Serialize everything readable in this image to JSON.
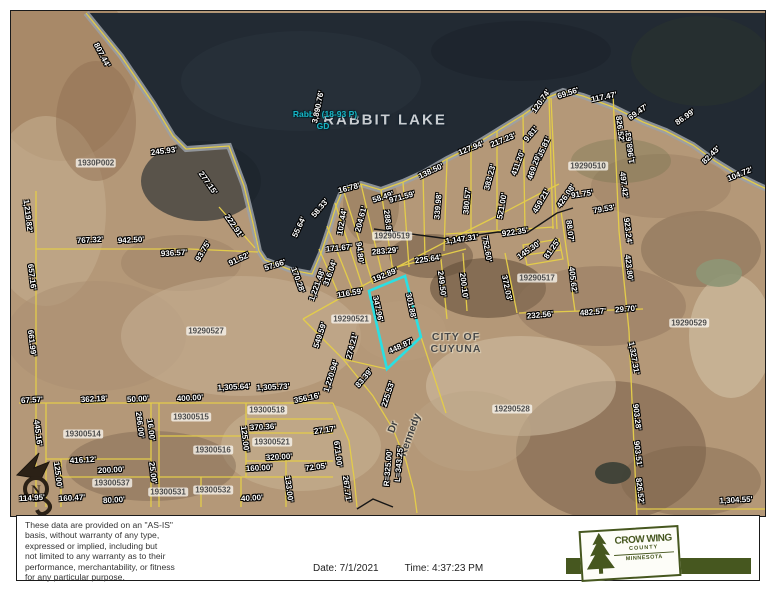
{
  "map": {
    "lake_name": "RABBIT LAKE",
    "lake_id_line1": "Rabbit (18-93 P)",
    "lake_id_line2": "GD",
    "lake_dimension": "3,890.76'",
    "city_line1": "CITY OF",
    "city_line2": "CUYUNA",
    "road_name": "Kennedy",
    "road_suffix": "Dr",
    "north_label": "N",
    "colors": {
      "highlight": "#2bdfe2",
      "parcel_line": "#e3cc4a",
      "water": "#222a33",
      "shore_band": "#9ba1a8",
      "label_text": "#ffffff"
    },
    "measurements": [
      {
        "t": "807.44'",
        "x": 101,
        "y": 54,
        "r": 62
      },
      {
        "t": "245.93'",
        "x": 163,
        "y": 150,
        "r": -7
      },
      {
        "t": "277.15'",
        "x": 207,
        "y": 182,
        "r": 55
      },
      {
        "t": "3,890.76'",
        "x": 317,
        "y": 106,
        "r": -78
      },
      {
        "t": "16.78'",
        "x": 348,
        "y": 187,
        "r": -15
      },
      {
        "t": "58.49'",
        "x": 382,
        "y": 196,
        "r": -18
      },
      {
        "t": "58.33'",
        "x": 319,
        "y": 207,
        "r": -50
      },
      {
        "t": "55.64'",
        "x": 298,
        "y": 226,
        "r": -65
      },
      {
        "t": "102.44'",
        "x": 341,
        "y": 221,
        "r": -80
      },
      {
        "t": "204.61'",
        "x": 360,
        "y": 218,
        "r": -75
      },
      {
        "t": "971.59'",
        "x": 401,
        "y": 196,
        "r": -15
      },
      {
        "t": "138.50'",
        "x": 430,
        "y": 170,
        "r": -25
      },
      {
        "t": "127.94'",
        "x": 470,
        "y": 147,
        "r": -22
      },
      {
        "t": "217.23'",
        "x": 502,
        "y": 139,
        "r": -22
      },
      {
        "t": "9.81'",
        "x": 530,
        "y": 133,
        "r": -50
      },
      {
        "t": "120.74'",
        "x": 540,
        "y": 100,
        "r": -55
      },
      {
        "t": "69.56'",
        "x": 567,
        "y": 92,
        "r": -18
      },
      {
        "t": "117.47'",
        "x": 603,
        "y": 96,
        "r": -12
      },
      {
        "t": "69.47'",
        "x": 637,
        "y": 111,
        "r": -35
      },
      {
        "t": "86.99'",
        "x": 684,
        "y": 116,
        "r": -35
      },
      {
        "t": "82.43'",
        "x": 710,
        "y": 154,
        "r": -45
      },
      {
        "t": "104.72'",
        "x": 739,
        "y": 173,
        "r": -22
      },
      {
        "t": "435.81'",
        "x": 542,
        "y": 148,
        "r": -65
      },
      {
        "t": "469.29'",
        "x": 533,
        "y": 166,
        "r": -70
      },
      {
        "t": "411.20'",
        "x": 517,
        "y": 162,
        "r": -70
      },
      {
        "t": "383.23'",
        "x": 489,
        "y": 176,
        "r": -75
      },
      {
        "t": "521.00'",
        "x": 501,
        "y": 205,
        "r": -80
      },
      {
        "t": "380.57'",
        "x": 466,
        "y": 200,
        "r": -85
      },
      {
        "t": "339.98'",
        "x": 437,
        "y": 205,
        "r": -85
      },
      {
        "t": "426.08'",
        "x": 565,
        "y": 195,
        "r": -55
      },
      {
        "t": "459.21'",
        "x": 540,
        "y": 200,
        "r": -60
      },
      {
        "t": "922.35'",
        "x": 514,
        "y": 231,
        "r": -8
      },
      {
        "t": "91.75'",
        "x": 581,
        "y": 193,
        "r": -8
      },
      {
        "t": "79.53'",
        "x": 603,
        "y": 208,
        "r": -10
      },
      {
        "t": "826.52'",
        "x": 619,
        "y": 128,
        "r": 83
      },
      {
        "t": "1,968.63'",
        "x": 629,
        "y": 146,
        "r": -97
      },
      {
        "t": "497.42'",
        "x": 623,
        "y": 184,
        "r": 83
      },
      {
        "t": "923.24'",
        "x": 627,
        "y": 230,
        "r": 83
      },
      {
        "t": "423.80'",
        "x": 628,
        "y": 267,
        "r": 83
      },
      {
        "t": "88.07'",
        "x": 569,
        "y": 230,
        "r": 83
      },
      {
        "t": "81.25'",
        "x": 551,
        "y": 248,
        "r": -55
      },
      {
        "t": "145.30'",
        "x": 528,
        "y": 249,
        "r": -35
      },
      {
        "t": "752.60'",
        "x": 486,
        "y": 248,
        "r": 80
      },
      {
        "t": "1,147.31'",
        "x": 461,
        "y": 238,
        "r": -8
      },
      {
        "t": "200.10'",
        "x": 463,
        "y": 285,
        "r": 83
      },
      {
        "t": "249.50'",
        "x": 441,
        "y": 283,
        "r": 83
      },
      {
        "t": "225.64'",
        "x": 427,
        "y": 258,
        "r": -8
      },
      {
        "t": "283.29'",
        "x": 384,
        "y": 250,
        "r": -5
      },
      {
        "t": "171.67'",
        "x": 338,
        "y": 247,
        "r": -5
      },
      {
        "t": "94.80'",
        "x": 359,
        "y": 252,
        "r": 83
      },
      {
        "t": "288.87'",
        "x": 387,
        "y": 222,
        "r": 83
      },
      {
        "t": "316.04'",
        "x": 329,
        "y": 272,
        "r": -70
      },
      {
        "t": "1,221.48'",
        "x": 316,
        "y": 284,
        "r": -70
      },
      {
        "t": "170.28'",
        "x": 297,
        "y": 279,
        "r": 70
      },
      {
        "t": "116.59'",
        "x": 349,
        "y": 292,
        "r": -10
      },
      {
        "t": "192.89'",
        "x": 384,
        "y": 274,
        "r": -22
      },
      {
        "t": "347.96'",
        "x": 377,
        "y": 308,
        "r": 78
      },
      {
        "t": "301.88'",
        "x": 410,
        "y": 305,
        "r": 78
      },
      {
        "t": "448.87'",
        "x": 400,
        "y": 345,
        "r": -25
      },
      {
        "t": "549.59'",
        "x": 319,
        "y": 334,
        "r": -72
      },
      {
        "t": "274.21'",
        "x": 351,
        "y": 345,
        "r": -75
      },
      {
        "t": "1,220.94'",
        "x": 330,
        "y": 375,
        "r": -72
      },
      {
        "t": "83.39'",
        "x": 363,
        "y": 377,
        "r": -50
      },
      {
        "t": "225.53'",
        "x": 387,
        "y": 393,
        "r": -72
      },
      {
        "t": "R=325.00'",
        "x": 387,
        "y": 467,
        "r": -85
      },
      {
        "t": "L=343.25'",
        "x": 398,
        "y": 463,
        "r": -85
      },
      {
        "t": "372.03'",
        "x": 506,
        "y": 287,
        "r": 78
      },
      {
        "t": "405.62'",
        "x": 572,
        "y": 279,
        "r": 83
      },
      {
        "t": "232.56'",
        "x": 539,
        "y": 314,
        "r": -5
      },
      {
        "t": "482.57'",
        "x": 592,
        "y": 311,
        "r": -5
      },
      {
        "t": "29.70'",
        "x": 625,
        "y": 308,
        "r": -5
      },
      {
        "t": "1,327.31'",
        "x": 633,
        "y": 357,
        "r": 80
      },
      {
        "t": "903.28'",
        "x": 636,
        "y": 416,
        "r": 83
      },
      {
        "t": "903.51'",
        "x": 637,
        "y": 453,
        "r": 83
      },
      {
        "t": "826.52'",
        "x": 639,
        "y": 490,
        "r": 83
      },
      {
        "t": "1,304.55'",
        "x": 735,
        "y": 499,
        "r": -3
      },
      {
        "t": "767.32'",
        "x": 89,
        "y": 239,
        "r": -3
      },
      {
        "t": "942.50'",
        "x": 130,
        "y": 239,
        "r": -3
      },
      {
        "t": "936.57'",
        "x": 173,
        "y": 252,
        "r": -3
      },
      {
        "t": "93.75'",
        "x": 202,
        "y": 250,
        "r": -60
      },
      {
        "t": "91.52'",
        "x": 238,
        "y": 258,
        "r": -25
      },
      {
        "t": "57.66'",
        "x": 274,
        "y": 264,
        "r": -18
      },
      {
        "t": "222.91'",
        "x": 233,
        "y": 225,
        "r": 55
      },
      {
        "t": "1,219.82'",
        "x": 27,
        "y": 215,
        "r": 83
      },
      {
        "t": "657.16'",
        "x": 31,
        "y": 276,
        "r": 83
      },
      {
        "t": "661.99'",
        "x": 31,
        "y": 342,
        "r": 83
      },
      {
        "t": "67.57'",
        "x": 31,
        "y": 399,
        "r": -3
      },
      {
        "t": "362.18'",
        "x": 93,
        "y": 398,
        "r": -3
      },
      {
        "t": "50.00'",
        "x": 137,
        "y": 398,
        "r": -3
      },
      {
        "t": "400.00'",
        "x": 189,
        "y": 397,
        "r": -3
      },
      {
        "t": "1,305.64'",
        "x": 233,
        "y": 386,
        "r": -3
      },
      {
        "t": "1,305.73'",
        "x": 272,
        "y": 386,
        "r": -3
      },
      {
        "t": "356.16'",
        "x": 306,
        "y": 397,
        "r": -12
      },
      {
        "t": "445.16'",
        "x": 37,
        "y": 432,
        "r": 83
      },
      {
        "t": "416.12'",
        "x": 82,
        "y": 459,
        "r": -3
      },
      {
        "t": "200.00'",
        "x": 110,
        "y": 469,
        "r": -3
      },
      {
        "t": "125.00'",
        "x": 57,
        "y": 474,
        "r": 83
      },
      {
        "t": "266.00'",
        "x": 139,
        "y": 424,
        "r": 83
      },
      {
        "t": "16.00'",
        "x": 150,
        "y": 429,
        "r": 83
      },
      {
        "t": "25.00'",
        "x": 152,
        "y": 472,
        "r": 83
      },
      {
        "t": "125.00'",
        "x": 244,
        "y": 438,
        "r": 83
      },
      {
        "t": "370.36'",
        "x": 262,
        "y": 426,
        "r": -3
      },
      {
        "t": "320.00'",
        "x": 278,
        "y": 456,
        "r": -3
      },
      {
        "t": "160.00'",
        "x": 258,
        "y": 467,
        "r": -3
      },
      {
        "t": "133.00'",
        "x": 288,
        "y": 488,
        "r": 83
      },
      {
        "t": "160.47'",
        "x": 71,
        "y": 497,
        "r": -3
      },
      {
        "t": "80.00'",
        "x": 113,
        "y": 499,
        "r": -3
      },
      {
        "t": "40.00'",
        "x": 251,
        "y": 497,
        "r": -3
      },
      {
        "t": "114.95'",
        "x": 31,
        "y": 497,
        "r": -3
      },
      {
        "t": "27.17'",
        "x": 324,
        "y": 429,
        "r": -8
      },
      {
        "t": "671.00'",
        "x": 337,
        "y": 453,
        "r": 83
      },
      {
        "t": "72.05'",
        "x": 315,
        "y": 466,
        "r": -8
      },
      {
        "t": "267.71'",
        "x": 346,
        "y": 488,
        "r": 83
      }
    ],
    "parcels": [
      {
        "t": "1930P002",
        "x": 95,
        "y": 162
      },
      {
        "t": "19290510",
        "x": 587,
        "y": 165
      },
      {
        "t": "19290519",
        "x": 391,
        "y": 235
      },
      {
        "t": "19290517",
        "x": 536,
        "y": 277
      },
      {
        "t": "19290521",
        "x": 350,
        "y": 318
      },
      {
        "t": "19290527",
        "x": 205,
        "y": 330
      },
      {
        "t": "19290528",
        "x": 511,
        "y": 408
      },
      {
        "t": "19290529",
        "x": 688,
        "y": 322
      },
      {
        "t": "19300514",
        "x": 82,
        "y": 433
      },
      {
        "t": "19300515",
        "x": 190,
        "y": 416
      },
      {
        "t": "19300516",
        "x": 212,
        "y": 449
      },
      {
        "t": "19300518",
        "x": 266,
        "y": 409
      },
      {
        "t": "19300521",
        "x": 271,
        "y": 441
      },
      {
        "t": "19300531",
        "x": 167,
        "y": 491
      },
      {
        "t": "19300532",
        "x": 212,
        "y": 489
      },
      {
        "t": "19300537",
        "x": 111,
        "y": 482
      }
    ]
  },
  "footer": {
    "disclaimer": "These data are provided on an \"AS-IS\"\nbasis, without warranty of any type,\nexpressed or implied, including but\nnot limited to any warranty as to their\nperformance, merchantability, or fitness\nfor any particular purpose.",
    "date": "Date: 7/1/2021",
    "time": "Time: 4:37:23 PM"
  },
  "logo": {
    "line1": "CROW WING",
    "line2": "COUNTY",
    "line3": "MINNESOTA",
    "green": "#46571f"
  }
}
